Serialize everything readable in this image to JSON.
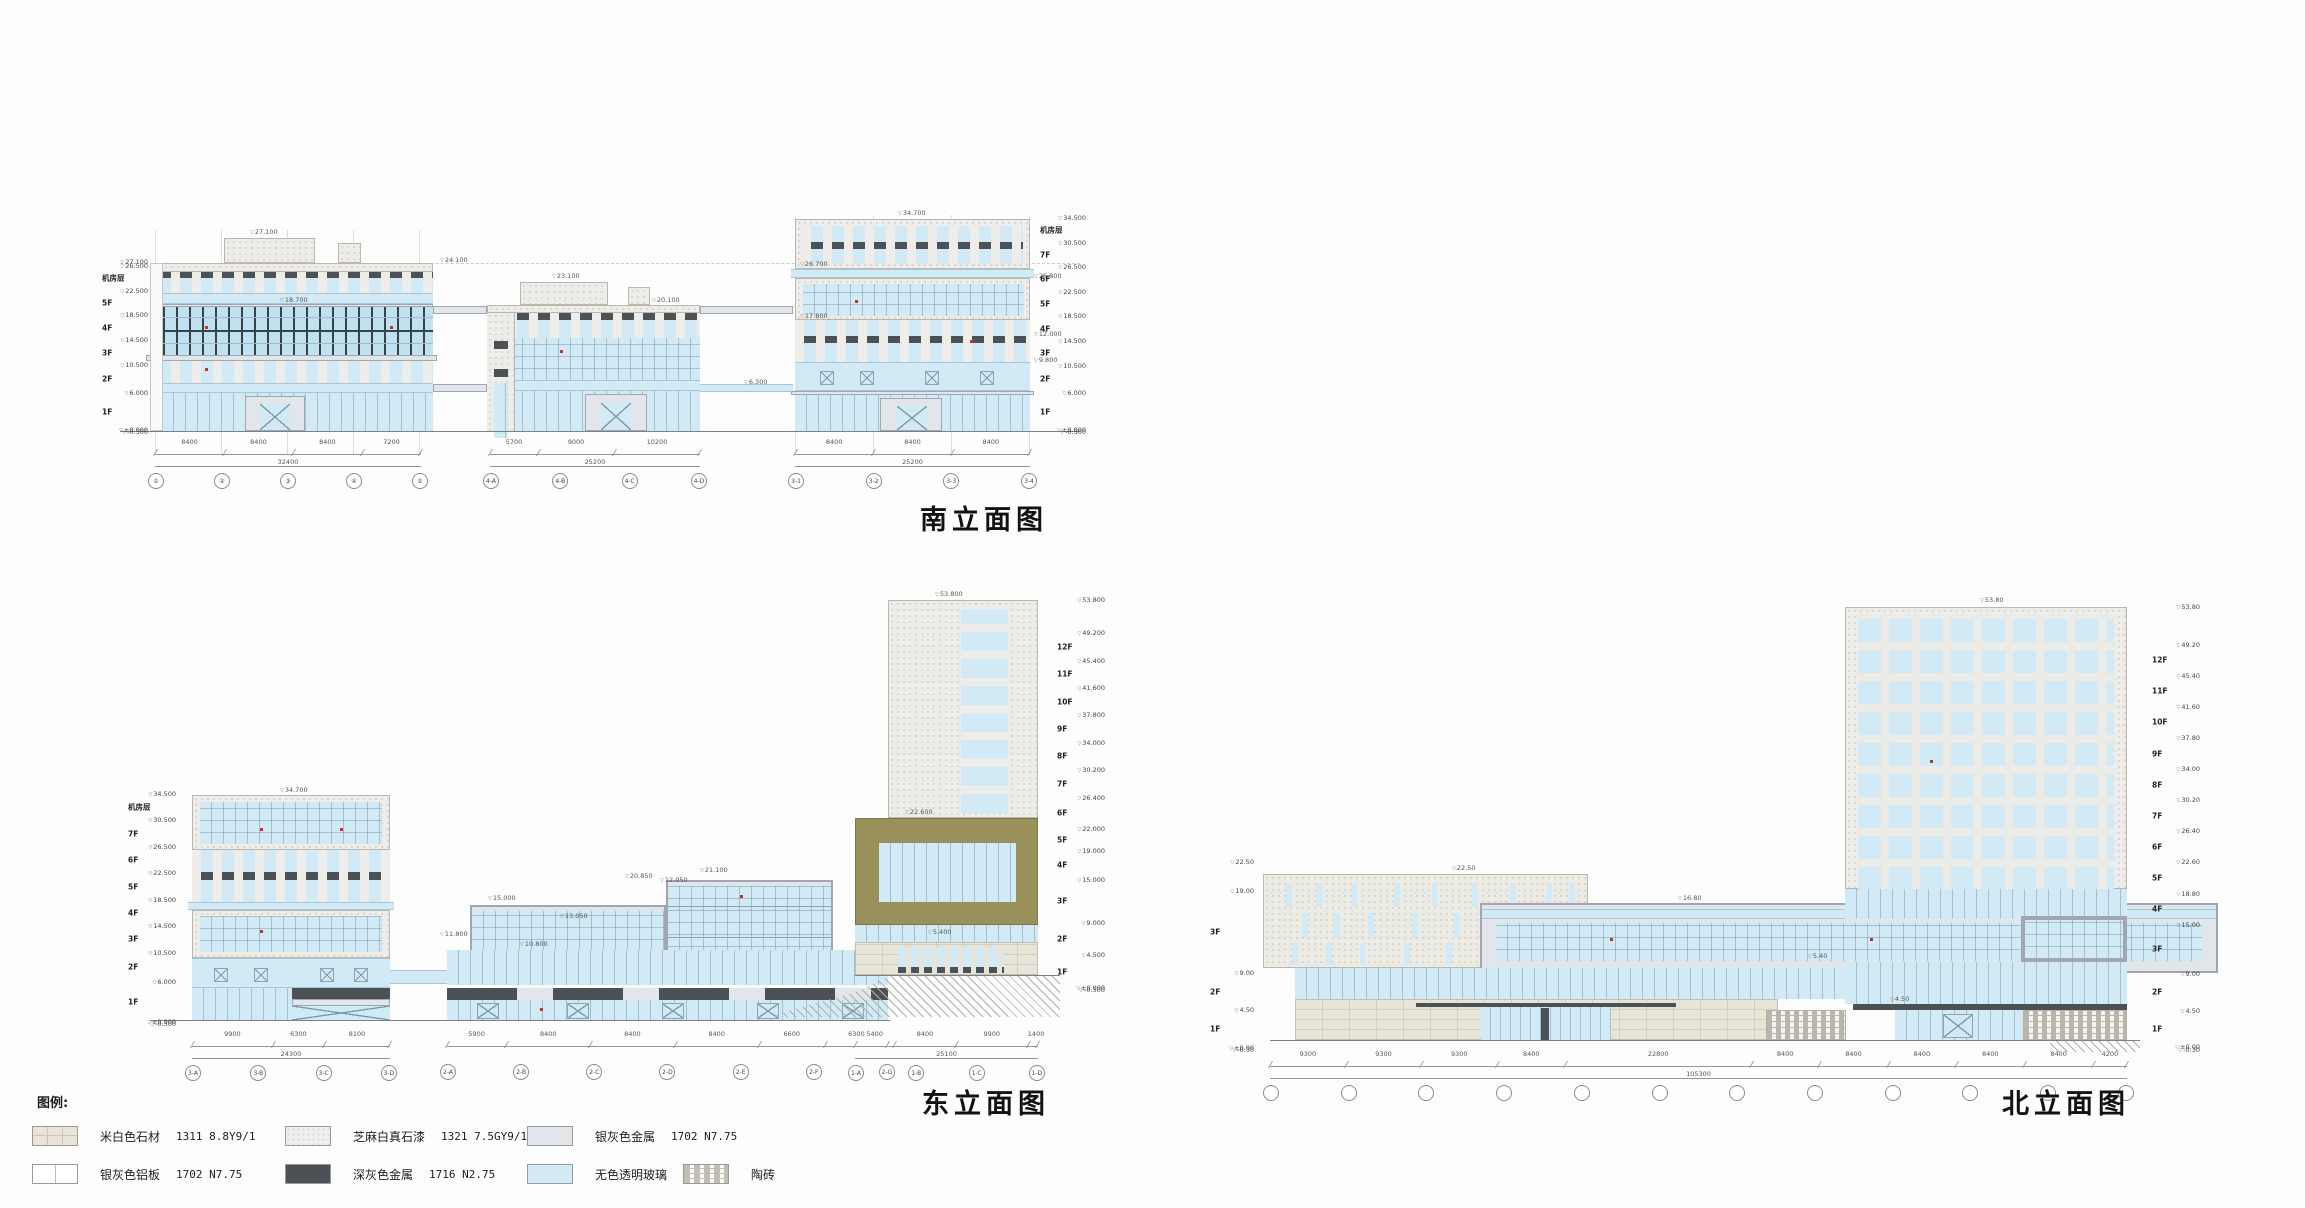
{
  "colors": {
    "glass": "#d2eaf5",
    "glassDeep": "#c0e1f0",
    "darkMullion": "#37434a",
    "speckleBase": "#eeedea",
    "stone": "#e8e5d8",
    "silver": "#e2e5ea",
    "darkMetal": "#4c5155",
    "olive": "#99905a",
    "red": "#c13327",
    "line": "#7a8187"
  },
  "titles": {
    "south": "南立面图",
    "west": "西立面图",
    "east": "东立面图",
    "north": "北立面图"
  },
  "legend": {
    "label": "图例:",
    "row1": [
      {
        "name": "米白色石材",
        "code": "1311 8.8Y9/1",
        "swatch": "stonesw"
      },
      {
        "name": "芝麻白真石漆",
        "code": "1321 7.5GY9/1",
        "swatch": "specklesw"
      },
      {
        "name": "银灰色金属",
        "code": "1702 N7.75",
        "swatch": "silversw"
      }
    ],
    "row2": [
      {
        "name": "银灰色铝板",
        "code": "1702 N7.75",
        "swatch": "alumsw"
      },
      {
        "name": "深灰色金属",
        "code": "1716 N2.75",
        "swatch": "darksw"
      },
      {
        "name": "无色透明玻璃",
        "code": "",
        "swatch": "glasssw"
      },
      {
        "name": "陶砖",
        "code": "",
        "swatch": "taosw"
      }
    ]
  },
  "south": {
    "ruler_left": [
      {
        "e": "27.100",
        "h": 0
      },
      {
        "e": "26.500",
        "h": 600
      },
      {
        "f": "机房层",
        "e": "22.500",
        "h": 4000
      },
      {
        "f": "5F",
        "e": "18.500",
        "h": 4000
      },
      {
        "f": "4F",
        "e": "14.500",
        "h": 4000
      },
      {
        "f": "3F",
        "e": "10.500",
        "h": 4000
      },
      {
        "f": "2F",
        "e": "6.000",
        "h": 4500
      },
      {
        "f": "1F",
        "e": "±0.000",
        "h": 6000
      },
      {
        "e": "-0.300",
        "h": 300
      }
    ],
    "ruler_right": [
      {
        "e": "34.500",
        "h": 0
      },
      {
        "f": "机房层",
        "e": "30.500",
        "h": 4000
      },
      {
        "f": "7F",
        "e": "26.500",
        "h": 4000
      },
      {
        "f": "6F",
        "e": "22.500",
        "h": 4000
      },
      {
        "f": "5F",
        "e": "18.500",
        "h": 4000
      },
      {
        "f": "4F",
        "e": "14.500",
        "h": 4000
      },
      {
        "f": "3F",
        "e": "10.500",
        "h": 4000
      },
      {
        "f": "2F",
        "e": "6.000",
        "h": 4500
      },
      {
        "f": "1F",
        "e": "±0.000",
        "h": 6000
      },
      {
        "e": "-0.300",
        "h": 300
      }
    ],
    "ann": {
      "a_roof": "27.100",
      "a_par": "24.100",
      "b_roof": "23.100",
      "b_par": "20.100",
      "ledge": "18.700",
      "c_top": "34.700",
      "c_l1": "26.700",
      "c_l2": "25.800",
      "c_l3": "17.800",
      "c_l4": "12.000",
      "c_l5": "9.800",
      "mid": "6.300"
    },
    "dims": {
      "g1": {
        "segs": [
          {
            "t": "8400",
            "w": 8400
          },
          {
            "t": "8400",
            "w": 8400
          },
          {
            "t": "8400",
            "w": 8400
          },
          {
            "t": "7200",
            "w": 7200
          }
        ],
        "total": "32400"
      },
      "g2": {
        "segs": [
          {
            "t": "5700",
            "w": 5700
          },
          {
            "t": "9000",
            "w": 9000
          },
          {
            "t": "10200",
            "w": 10200
          }
        ],
        "total": "25200"
      },
      "g3": {
        "segs": [
          {
            "t": "8400",
            "w": 8400
          },
          {
            "t": "8400",
            "w": 8400
          },
          {
            "t": "8400",
            "w": 8400
          }
        ],
        "total": "25200"
      }
    },
    "bubbles": {
      "g1": [
        "①",
        "②",
        "③",
        "④",
        "⑤"
      ],
      "g2": [
        "4-A",
        "4-B",
        "4-C",
        "4-D"
      ],
      "g3": [
        "3-1",
        "3-2",
        "3-3",
        "3-4"
      ]
    }
  },
  "west": {
    "ruler_left": [
      {
        "e": "53.800",
        "h": 0
      },
      {
        "e": "49.200",
        "h": 4600
      },
      {
        "f": "12F",
        "e": "45.400",
        "h": 3800
      },
      {
        "f": "11F",
        "e": "41.600",
        "h": 3800
      },
      {
        "f": "10F",
        "e": "37.800",
        "h": 3800
      },
      {
        "f": "9F",
        "e": "34.000",
        "h": 3800
      },
      {
        "f": "8F",
        "e": "30.200",
        "h": 3800
      },
      {
        "f": "7F",
        "e": "26.400",
        "h": 3800
      },
      {
        "f": "6F",
        "e": "22.600",
        "h": 3800
      },
      {
        "f": "5F",
        "e": "18.800",
        "h": 3800
      },
      {
        "f": "4F",
        "e": "15.000",
        "h": 3800
      },
      {
        "f": "3F",
        "e": "9.000",
        "h": 6000
      },
      {
        "f": "2F",
        "e": "4.500",
        "h": 4500
      },
      {
        "f": "1F",
        "e": "±0.000",
        "h": 4500
      },
      {
        "e": "-0.300",
        "h": 300
      }
    ],
    "ruler_right": [
      {
        "e": "27.100(机房)",
        "h": 0
      },
      {
        "e": "26.500",
        "h": 600
      },
      {
        "f": "机房层",
        "e": "22.500",
        "h": 4000
      },
      {
        "f": "5F",
        "e": "18.500",
        "h": 4000
      },
      {
        "f": "4F",
        "e": "14.500",
        "h": 4000
      },
      {
        "f": "3F",
        "e": "10.500",
        "h": 4000
      },
      {
        "f": "2F",
        "e": "6.000",
        "h": 4500
      },
      {
        "f": "1F",
        "e": "±0.000",
        "h": 6000
      },
      {
        "e": "-0.300",
        "h": 300
      }
    ],
    "ann": {
      "t_top": "53.800",
      "t_top2": "53.800",
      "mid_roof": "21.800",
      "r_par": "24.100",
      "r_ledge": "18.700",
      "r_l2": "9.800",
      "r_l3": "5.300"
    },
    "dims": {
      "g1": {
        "segs": [
          {
            "t": "9900",
            "w": 9900
          },
          {
            "t": "8400",
            "w": 8400
          }
        ],
        "total": "18300"
      },
      "g2": {
        "segs": [
          {
            "t": "8500",
            "w": 8500
          },
          {
            "t": "8400",
            "w": 8400
          },
          {
            "t": "8400",
            "w": 8400
          },
          {
            "t": "8400",
            "w": 8400
          },
          {
            "t": "8400",
            "w": 8400
          }
        ],
        "total": "58900"
      },
      "g3": {
        "segs": [
          {
            "t": "8100",
            "w": 8100
          },
          {
            "t": "6300",
            "w": 6300
          },
          {
            "t": "8400",
            "w": 8400
          }
        ],
        "total": "22800"
      }
    },
    "bubbles": {
      "g1": [
        "1-D",
        "1-C",
        "1-B"
      ],
      "g2": [
        "5-G",
        "5-F",
        "5-E",
        "5-D",
        "5-C",
        "5-B"
      ],
      "g3": [
        "4-D",
        "4-C",
        "4-B",
        "4-A"
      ]
    }
  },
  "east": {
    "ruler_left": [
      {
        "e": "34.500",
        "h": 0
      },
      {
        "f": "机房层",
        "e": "30.500",
        "h": 4000
      },
      {
        "f": "7F",
        "e": "26.500",
        "h": 4000
      },
      {
        "f": "6F",
        "e": "22.500",
        "h": 4000
      },
      {
        "f": "5F",
        "e": "18.500",
        "h": 4000
      },
      {
        "f": "4F",
        "e": "14.500",
        "h": 4000
      },
      {
        "f": "3F",
        "e": "10.500",
        "h": 4000
      },
      {
        "f": "2F",
        "e": "6.000",
        "h": 4500
      },
      {
        "f": "1F",
        "e": "±0.000",
        "h": 6000
      },
      {
        "e": "-0.300",
        "h": 300
      }
    ],
    "ruler_right": [
      {
        "e": "53.800",
        "h": 0
      },
      {
        "e": "49.200",
        "h": 4600
      },
      {
        "f": "12F",
        "e": "45.400",
        "h": 3800
      },
      {
        "f": "11F",
        "e": "41.600",
        "h": 3800
      },
      {
        "f": "10F",
        "e": "37.800",
        "h": 3800
      },
      {
        "f": "9F",
        "e": "34.000",
        "h": 3800
      },
      {
        "f": "8F",
        "e": "30.200",
        "h": 3800
      },
      {
        "f": "7F",
        "e": "26.400",
        "h": 3800
      },
      {
        "f": "6F",
        "e": "22.000",
        "h": 4400
      },
      {
        "f": "5F",
        "e": "19.000",
        "h": 3000
      },
      {
        "f": "4F",
        "e": "15.000",
        "h": 4000
      },
      {
        "f": "3F",
        "e": "9.000",
        "h": 6000
      },
      {
        "f": "2F",
        "e": "4.500",
        "h": 4500
      },
      {
        "f": "1F",
        "e": "±0.000",
        "h": 4500
      },
      {
        "e": "-0.300",
        "h": 300
      }
    ],
    "ann": {
      "l_top": "34.700",
      "m1": "21.100",
      "m2": "20.850",
      "m3": "15.000",
      "m4": "13.050",
      "m5": "10.800",
      "m6": "11.800",
      "t_top": "53.800",
      "t_6f": "22.600",
      "t_door": "5.400",
      "t_12": "12.050"
    },
    "dims": {
      "g1": {
        "segs": [
          {
            "t": "9900",
            "w": 9900
          },
          {
            "t": "6300",
            "w": 6300
          },
          {
            "t": "8100",
            "w": 8100
          }
        ],
        "total": "24300"
      },
      "g2": {
        "segs": [
          {
            "t": "5900",
            "w": 5900
          },
          {
            "t": "8400",
            "w": 8400
          },
          {
            "t": "8400",
            "w": 8400
          },
          {
            "t": "8400",
            "w": 8400
          },
          {
            "t": "6600",
            "w": 6600
          },
          {
            "t": "6300",
            "w": 6300
          }
        ],
        "total": ""
      },
      "g3": {
        "segs": [
          {
            "t": "5400",
            "w": 5400
          },
          {
            "t": "8400",
            "w": 8400
          },
          {
            "t": "9900",
            "w": 9900
          },
          {
            "t": "1400",
            "w": 1400
          }
        ],
        "total": "25100"
      }
    },
    "bubbles": {
      "g1": [
        "3-A",
        "3-B",
        "3-C",
        "3-D"
      ],
      "g2": [
        "2-A",
        "2-B",
        "2-C",
        "2-D",
        "2-E",
        "2-F",
        "2-G"
      ],
      "g3": [
        "1-A",
        "1-B",
        "1-C",
        "1-D"
      ]
    }
  },
  "north": {
    "ruler_left": [
      {
        "e": "22.50",
        "h": 0
      },
      {
        "e": "19.00",
        "h": 3500
      },
      {
        "f": "3F",
        "e": "9.00",
        "h": 10000
      },
      {
        "f": "2F",
        "e": "4.50",
        "h": 4500
      },
      {
        "f": "1F",
        "e": "±0.00",
        "h": 4500
      },
      {
        "e": "-0.30",
        "h": 300
      }
    ],
    "ruler_right": [
      {
        "e": "53.80",
        "h": 0
      },
      {
        "e": "49.20",
        "h": 4600
      },
      {
        "f": "12F",
        "e": "45.40",
        "h": 3800
      },
      {
        "f": "11F",
        "e": "41.60",
        "h": 3800
      },
      {
        "f": "10F",
        "e": "37.80",
        "h": 3800
      },
      {
        "f": "9F",
        "e": "34.00",
        "h": 3800
      },
      {
        "f": "8F",
        "e": "30.20",
        "h": 3800
      },
      {
        "f": "7F",
        "e": "26.40",
        "h": 3800
      },
      {
        "f": "6F",
        "e": "22.60",
        "h": 3800
      },
      {
        "f": "5F",
        "e": "18.80",
        "h": 3800
      },
      {
        "f": "4F",
        "e": "15.00",
        "h": 3800
      },
      {
        "f": "3F",
        "e": "9.00",
        "h": 6000
      },
      {
        "f": "2F",
        "e": "4.50",
        "h": 4500
      },
      {
        "f": "1F",
        "e": "±0.00",
        "h": 4500
      },
      {
        "e": "-0.30",
        "h": 300
      }
    ],
    "ann": {
      "l_top": "22.50",
      "bridge": "16.80",
      "tag1": "5.40",
      "tag2": "4.50",
      "t_top": "53.80"
    },
    "dims": {
      "g1": {
        "segs": [
          {
            "t": "9300",
            "w": 9300
          },
          {
            "t": "9300",
            "w": 9300
          },
          {
            "t": "9300",
            "w": 9300
          },
          {
            "t": "8400",
            "w": 8400
          },
          {
            "t": "22800",
            "w": 22800
          },
          {
            "t": "8400",
            "w": 8400
          },
          {
            "t": "8400",
            "w": 8400
          },
          {
            "t": "8400",
            "w": 8400
          },
          {
            "t": "8400",
            "w": 8400
          },
          {
            "t": "8400",
            "w": 8400
          },
          {
            "t": "4200",
            "w": 4200
          }
        ],
        "total": "105300"
      }
    },
    "bubbles": {
      "g1": [
        "",
        "",
        "",
        "",
        "",
        "",
        "",
        "",
        "",
        "",
        "",
        ""
      ]
    }
  }
}
